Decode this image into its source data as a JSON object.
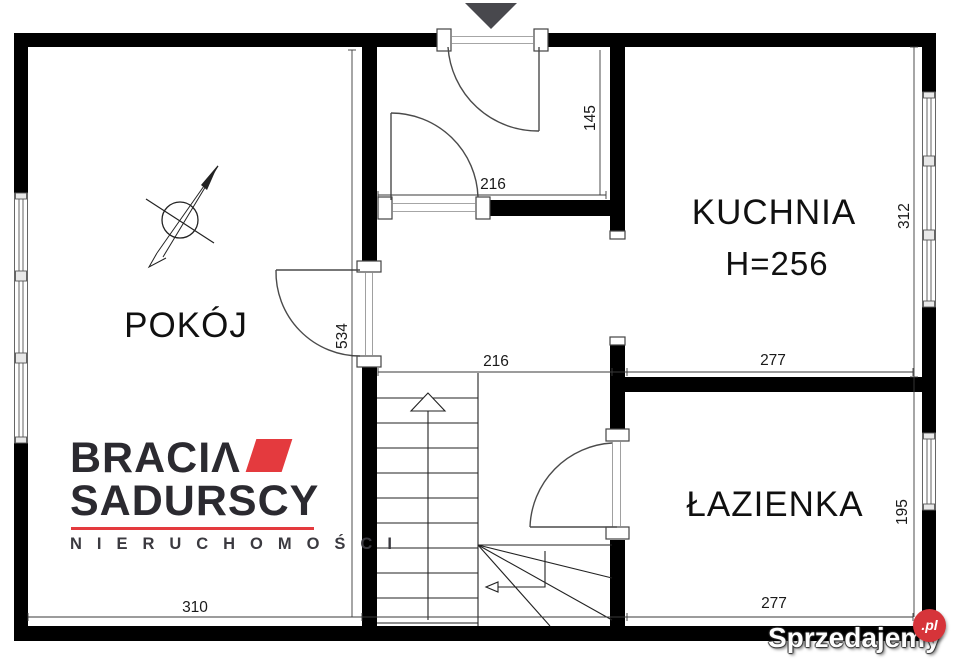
{
  "plan_title": "apartment floor plan",
  "rooms": {
    "pokoj": "POKÓJ",
    "kuchnia": "KUCHNIA",
    "kuchnia_height": "H=256",
    "lazienka": "ŁAZIENKA"
  },
  "dimensions": {
    "hall_width": "216",
    "hall_depth": "145",
    "corridor_width": "216",
    "kitchen_width": "277",
    "kitchen_length": "312",
    "pokoj_length": "534",
    "pokoj_width": "310",
    "bathroom_width": "277",
    "bathroom_length": "195"
  },
  "markers": {
    "entrance": "entrance-arrow-down-icon",
    "north": "north-arrow-icon",
    "stairs_up": "stairs-up-arrow-icon"
  },
  "logo": {
    "line1": "BRACIΛ",
    "line2": "SADURSCY",
    "line3": "N I E R U C H O M O Ś C I"
  },
  "watermark": {
    "text": "Sprzedajemy",
    "suffix": ".pl"
  },
  "colors": {
    "wall": "#000000",
    "logo_text": "#2b2a30",
    "logo_red": "#e43a3e",
    "watermark_red": "#d6343a",
    "entrance_marker": "#48484d"
  }
}
